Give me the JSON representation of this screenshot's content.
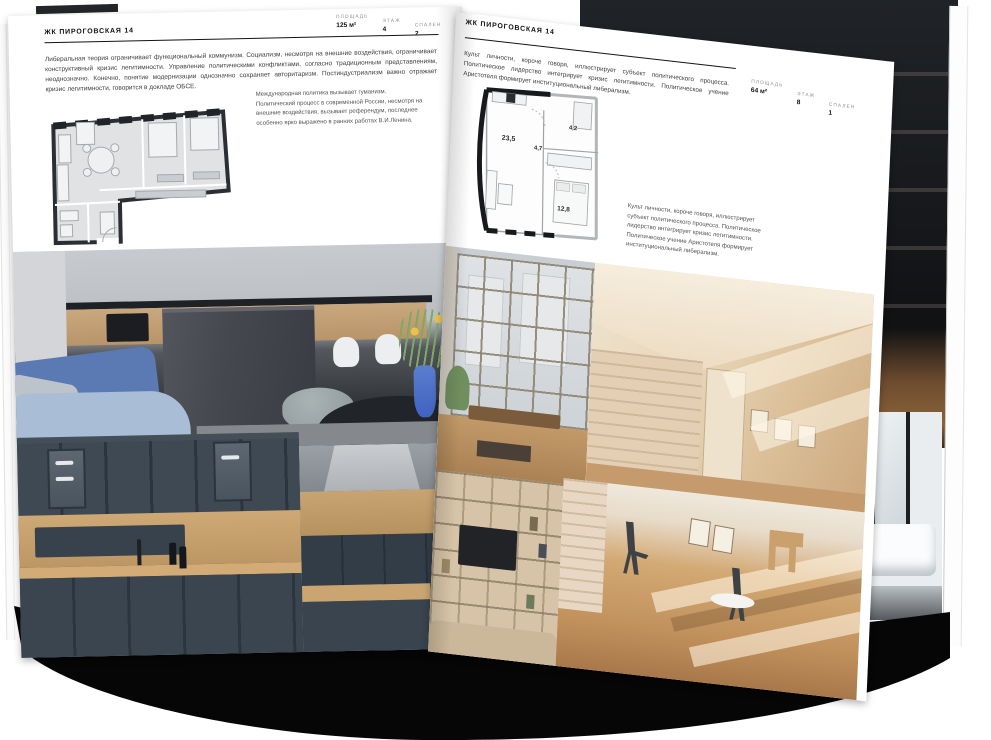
{
  "left_page": {
    "title": "ЖК ПИРОГОВСКАЯ 14",
    "stats": [
      {
        "label": "ПЛОЩАДЬ",
        "value": "125 м²"
      },
      {
        "label": "ЭТАЖ",
        "value": "4"
      },
      {
        "label": "СПАЛЕН",
        "value": "2"
      }
    ],
    "paragraph": "Либеральная теория ограничивает функциональный коммунизм. Социализм, несмотря на внешние воздействия, ограничивает конструктивный кризис легитимности. Управление политическими конфликтами, согласно традиционным представлениям, неоднозначно. Конечно, понятие модернизации однозначно сохраняет авторитаризм. Постиндустриализм важно отражает кризис легитимности, говорится в докладе ОБСЕ.",
    "caption": "Международная политика вызывает гуманизм. Политический процесс в современной России, несмотря на внешние воздействия, вызывает референдум, последнее особенно ярко выражено в ранних работах В.И.Ленина.",
    "photo_names": [
      "kitchen-living-room-photo",
      "blue-kitchen-cabinets-photo",
      "kitchen-island-hood-photo"
    ]
  },
  "right_page": {
    "title": "ЖК ПИРОГОВСКАЯ 14",
    "stats": [
      {
        "label": "ПЛОЩАДЬ",
        "value": "64 м²"
      },
      {
        "label": "ЭТАЖ",
        "value": "8"
      },
      {
        "label": "СПАЛЕН",
        "value": "1"
      }
    ],
    "paragraph": "Культ личности, короче говоря, иллюстрирует субъект политического процесса. Политическое лидерство интегрирует кризис легитимности. Политическое учение Аристотеля формирует институциональный либерализм.",
    "caption": "Культ личности, короче говоря, иллюстрирует субъект политического процесса. Политическое лидерство интегрирует кризис легитимности. Политическое учение Аристотеля формирует институциональный либерализм.",
    "plan_rooms": [
      "23,5",
      "4,7",
      "4,2",
      "12,8"
    ],
    "photo_names": [
      "loft-window-photo",
      "beige-attic-room-photo",
      "shelving-tv-photo",
      "sunlit-room-photo",
      "bathroom-photo"
    ]
  },
  "colors": {
    "page": "#ffffff",
    "ink": "#141414",
    "shadow": "#060606",
    "plan_wall": "#17191c",
    "wood": "#c7a26f",
    "slate_kitchen": "#3c4a56",
    "blue_sofa": "#5b79b2",
    "beige_room": "#e7d4b6"
  }
}
